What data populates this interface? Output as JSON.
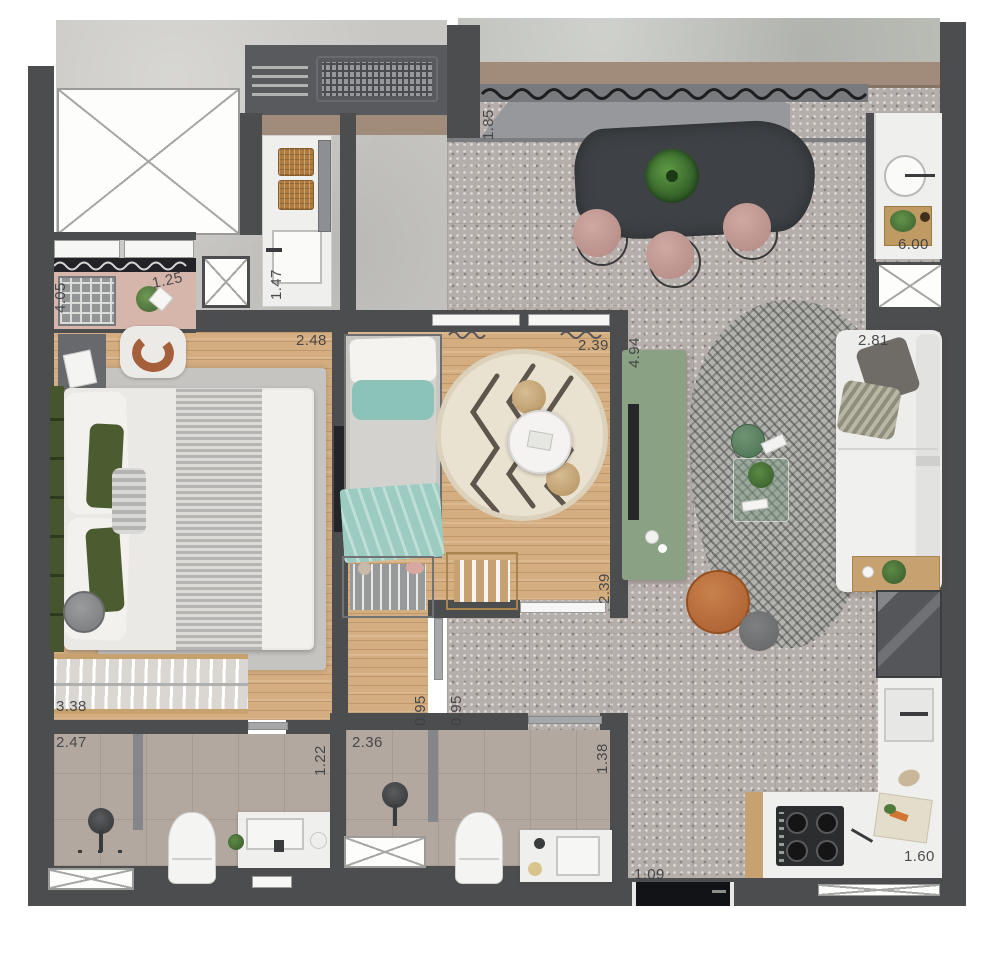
{
  "plan_type": "apartment-floor-plan-top-view",
  "dimension_labels": {
    "terrace_depth": "1.85",
    "kitchen_top_run": "6.00",
    "balcony_length": "4.05",
    "balcony_depth": "1.25",
    "laundry_depth": "1.47",
    "bedroom1_top_width": "2.48",
    "bedroom2_top_width": "2.39",
    "bedroom2_length": "4.94",
    "sofa_wall_width": "2.81",
    "bedroom2_lower_depth": "2.39",
    "wardrobe_run": "3.38",
    "door_left": "0.95",
    "door_right": "0.95",
    "bath1_width": "2.47",
    "bath1_depth": "1.22",
    "bath2_width": "2.36",
    "bath2_depth": "1.38",
    "bottom_door_width": "1.09",
    "kitchen_counter_run": "1.60"
  },
  "colors": {
    "wall": "#4c4d4f",
    "wood_floor": "#d4ad80",
    "terrazzo_floor": "#b6aeab",
    "concrete_floor": "#c8c7c3",
    "bathroom_tile": "#b2a8a0",
    "balcony_pink_floor": "#d6b5ab",
    "planter_band": "#a18c7c",
    "green_console": "#8aa183",
    "teal_textile": "#8cc3b8",
    "orange_pouf": "#b5693a",
    "stool_pink": "#c29a93",
    "dining_table_dark": "#3e4246",
    "sofa_white": "#ededeb",
    "round_rug_cream": "#eae2d0",
    "accent_pillow_green": "#4c5c31"
  },
  "furniture": [
    "double-bed",
    "single-bed",
    "dining-table",
    "sofa",
    "tv-console",
    "coffee-tables",
    "orange-pouf",
    "gray-stool",
    "round-rug",
    "houndstooth-rug",
    "wardrobe-rack",
    "dresser",
    "bookshelf",
    "toilets",
    "showers",
    "vanities",
    "cooktop",
    "kitchen-sinks",
    "fridge",
    "laundry-counter",
    "ac-unit",
    "vertical-garden",
    "dining-stools"
  ]
}
